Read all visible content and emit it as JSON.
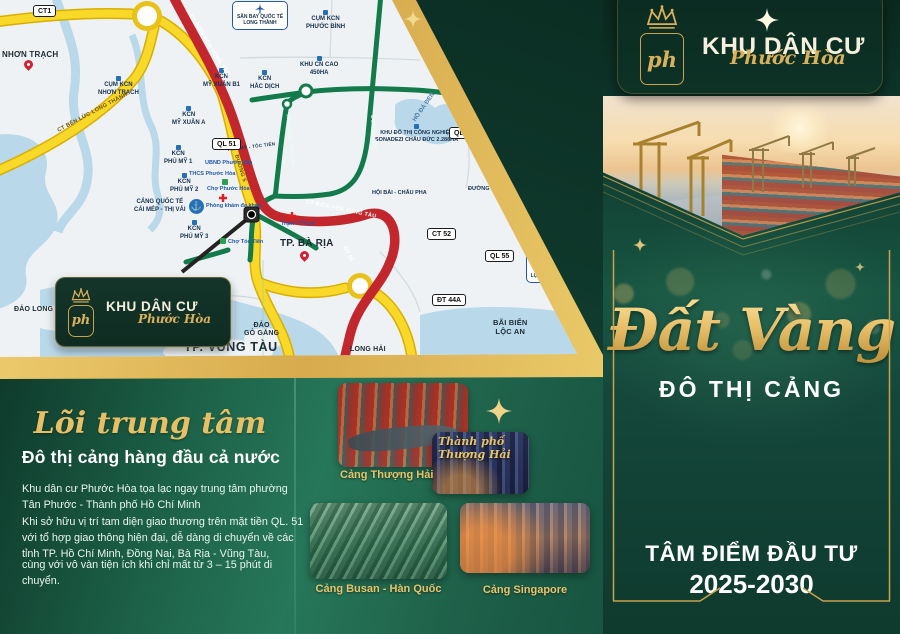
{
  "brand": {
    "line1": "KHU DÂN CƯ",
    "script": "Phước Hòa",
    "monogram": "ph"
  },
  "right_panel": {
    "headline_script": "Đất Vàng",
    "headline_caps": "ĐÔ THỊ CẢNG",
    "footer_line1": "TÂM ĐIỂM ĐẦU TƯ",
    "footer_line2": "2025-2030"
  },
  "left_section": {
    "title_script": "Lõi trung tâm",
    "title_main": "Đô thị cảng hàng đầu cả nước",
    "p1": "Khu dân cư Phước Hòa tọa lạc ngay trung tâm phường Tân Phước - Thành phố Hồ Chí Minh",
    "p2": "Khi sở hữu vị trí tam diện giao thương trên mặt tiền QL. 51 với tổ hợp giao thông hiện đại, dễ dàng di chuyển về các tỉnh TP. Hồ Chí Minh, Đồng Nai, Bà Rịa - Vũng Tàu,",
    "p3": "cùng với vô vàn tiện ích khi chỉ mất từ 3 – 15 phút di chuyển.",
    "captions": {
      "shanghai_port": "Cảng Thượng Hải",
      "shanghai_city": "Thành phố\nThượng Hải",
      "busan": "Cảng Busan - Hàn Quốc",
      "singapore": "Cảng Singapore"
    }
  },
  "map": {
    "badges": [
      "CT1",
      "QL 51",
      "QL 56",
      "CT 52",
      "QL 55",
      "ĐT 44A"
    ],
    "airports": [
      "SÂN BAY QUỐC TẾ\nLONG THÀNH",
      "SÂN BAY\nLỘC AN - HỒ TRÀM"
    ],
    "cities": [
      "NHƠN TRẠCH",
      "TP. BÀ RỊA",
      "TP. VŨNG TÀU",
      "ĐẢO LONG SƠN",
      "ĐẢO\nGÒ GĂNG",
      "LONG HẢI",
      "BÃI BIỂN\nLỘC AN"
    ],
    "zones": [
      "CỤM KCN\nNHƠN TRẠCH",
      "CỤM KCN\nPHƯỚC BÌNH",
      "KCN\nMỸ XUÂN B1",
      "KCN\nHẮC DỊCH",
      "KHU CN CAO\n450HA",
      "KCN\nMỸ XUÂN A",
      "KCN\nPHÚ MỸ 1",
      "KCN\nPHÚ MỸ 2",
      "KCN\nPHÚ MỸ 3",
      "KHU ĐÔ THỊ CÔNG NGHIỆP\nSONADEZI CHÂU ĐỨC 2.288HA",
      "HỘI BÀI - CHÂU PHA",
      "ĐƯỜNG SỐ 1",
      "HỒ ĐÁ ĐEN",
      "CẢNG QUỐC TẾ\nCÁI MÉP - THỊ VẢI"
    ],
    "pois": [
      "UBND Phước Hòa",
      "THCS Phước Hòa",
      "Chợ Phước Hòa",
      "Phòng khám đa khoa",
      "Trạm Y Tế xã",
      "Chợ Tóc Tiên"
    ],
    "roads": [
      "CT BIÊN HÒA VŨNG TÀU",
      "CT BIÊN HÒA VŨNG TÀU",
      "CT BẾN LỨC LONG THÀNH",
      "ĐƯỜNG 5",
      "ĐƯỜNG 991",
      "HẮC DỊCH - TÓC TIÊN",
      "PHÚ MỸ - TÓC TIÊN",
      "ĐT 56"
    ]
  },
  "icons": {
    "crown": "crown-icon",
    "plane": "plane-icon",
    "anchor": "anchor-icon",
    "pin": "map-pin-icon",
    "cross": "medical-cross-icon",
    "sparkle": "sparkle-icon"
  },
  "colors": {
    "gold": "#d9b05c",
    "dark_green": "#0d352a",
    "emerald": "#1e6b4e",
    "road_yellow": "#f6d420",
    "road_red": "#c1272d",
    "road_green": "#127a4b",
    "water": "#b9d8ea"
  }
}
